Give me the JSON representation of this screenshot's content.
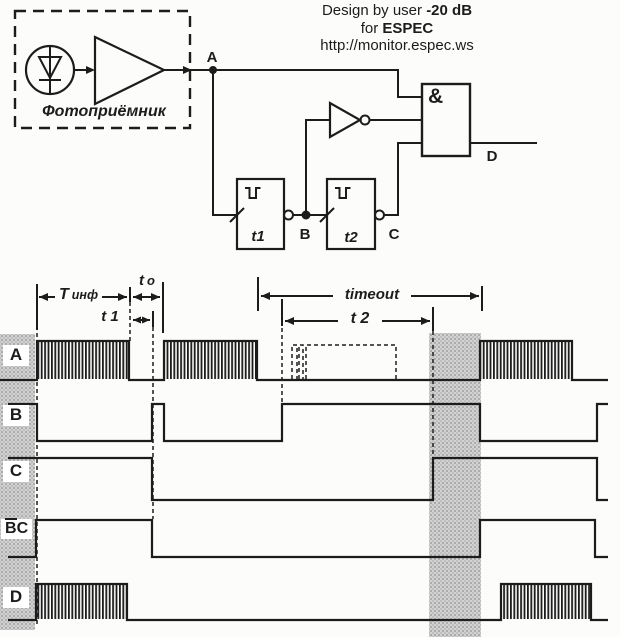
{
  "header": {
    "line1_prefix": "Design by user ",
    "line1_bold": "-20 dB",
    "line2_prefix": "for ",
    "line2_bold": "ESPEC",
    "line3": "http://monitor.espec.ws"
  },
  "circuit": {
    "photoreceiver_label": "Фотоприёмник",
    "node_a": "A",
    "node_b": "B",
    "node_c": "C",
    "node_d": "D",
    "and_symbol": "&",
    "t1_label": "t1",
    "t2_label": "t2"
  },
  "timing": {
    "t_inf_main": "Т",
    "t_inf_sub": "инф",
    "t_o_main": "t",
    "t_o_sub": "o",
    "t_1": "t 1",
    "t_2": "t 2",
    "timeout": "timeout",
    "row_a": "A",
    "row_b": "B",
    "row_c": "C",
    "row_bc_bar": "B",
    "row_bc_rest": "C",
    "row_d": "D"
  },
  "colors": {
    "ink": "#1c1c1c",
    "paper": "#fcfcfa",
    "shade": "#d2d2d2"
  },
  "signals": {
    "A": {
      "high": 341,
      "low": 380,
      "segments": [
        [
          "low",
          0,
          37
        ],
        [
          "burst",
          37,
          129
        ],
        [
          "low",
          129,
          164
        ],
        [
          "burst",
          164,
          257
        ],
        [
          "low",
          257,
          480
        ],
        [
          "burst",
          480,
          572
        ],
        [
          "low",
          572,
          608
        ]
      ],
      "ghost": "M292,379 L292,345 L297,345 L297,379 M299,379 L299,345 L303,345 L303,379 M306,379 L306,345 L396,345 L396,379"
    },
    "B": {
      "high": 404,
      "low": 441,
      "segments": [
        [
          "high",
          8,
          37
        ],
        [
          "low",
          37,
          152
        ],
        [
          "high",
          152,
          164
        ],
        [
          "low",
          164,
          282
        ],
        [
          "high",
          282,
          480
        ],
        [
          "low",
          480,
          597
        ],
        [
          "high",
          597,
          608
        ]
      ]
    },
    "C": {
      "high": 458,
      "low": 500,
      "segments": [
        [
          "high",
          8,
          152
        ],
        [
          "low",
          152,
          433
        ],
        [
          "high",
          433,
          597
        ],
        [
          "low",
          597,
          608
        ]
      ]
    },
    "BC": {
      "high": 520,
      "low": 557,
      "segments": [
        [
          "low",
          8,
          36
        ],
        [
          "high",
          36,
          152
        ],
        [
          "low",
          152,
          480
        ],
        [
          "high",
          480,
          595
        ],
        [
          "low",
          595,
          608
        ]
      ]
    },
    "D": {
      "high": 584,
      "low": 620,
      "segments": [
        [
          "low",
          8,
          36
        ],
        [
          "burst",
          36,
          127
        ],
        [
          "low",
          127,
          501
        ],
        [
          "burst",
          501,
          591
        ],
        [
          "low",
          591,
          608
        ]
      ]
    }
  }
}
